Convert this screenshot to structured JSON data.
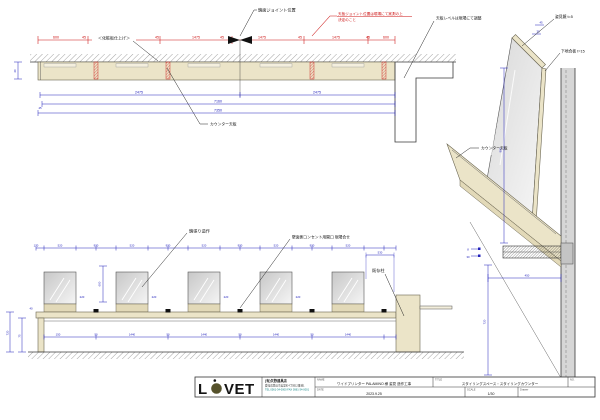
{
  "colors": {
    "beige": "#ebe4c8",
    "beige_dark": "#e2d9b8",
    "blue": "#2222bb",
    "red": "#cc1111",
    "teal": "#0a8080",
    "logo_olive": "#55512b",
    "wall_gray": "#d6d6d6"
  },
  "plan": {
    "labels": {
      "joint": "鏡面ジョイント位置",
      "note1": "天板ジョイント位置は現場にて実測の上",
      "note2": "決定のこと",
      "level": "天板レベルは現場にて調整",
      "finish": "＜化粧板仕上げ＞",
      "counter": "カウンター天板"
    },
    "red_dims": [
      "600",
      "45",
      "1475",
      "45",
      "1475",
      "45",
      "1475",
      "45",
      "1475",
      "45",
      "600"
    ],
    "blue_dims": {
      "half_a": "2475",
      "half_b": "2475",
      "inner": "7160",
      "overall": "7350",
      "depth": "40",
      "offset": "45"
    }
  },
  "elevation": {
    "top_dims": [
      "170",
      "520",
      "930",
      "520",
      "930",
      "520",
      "930",
      "520",
      "930",
      "520"
    ],
    "bottom_dims": [
      "150",
      "50",
      "1440",
      "50",
      "1440",
      "50",
      "1440",
      "50",
      "1440"
    ],
    "gap_dim": "530",
    "side_dim": "220",
    "mirror_h": "600",
    "left_dims": {
      "top": "40",
      "apron": "75",
      "height": "720"
    },
    "labels": {
      "mirror": "鏡張り造作",
      "outlet": "壁面側コンセント用開口 現場合せ",
      "column": "既存柱"
    }
  },
  "section": {
    "labels": {
      "mirror": "姿見鏡 t=5",
      "backing": "下地合板 t=15",
      "counter": "カウンター天板"
    },
    "dims": {
      "height": "900",
      "leg": "720",
      "depth": "450",
      "top_a": "45",
      "top_b": "30",
      "fix_a": "8",
      "fix_b": "30"
    }
  },
  "titleblock": {
    "logo_l": "L",
    "logo_vet": "VET",
    "company_name": "(有)矢野建具店",
    "company_address": "愛知県豊田市美里町4丁目12番地1",
    "company_tel": "TEL 0561-34-0000  FAX 0561-34-0001",
    "name_label": "NAME",
    "name_value": "ワイドプリンター PALAMINO 様 姿見 造作工事",
    "title_label": "TITLE",
    "title_value": "スタイリングスペース・スタイリングカウンター",
    "no_label": "NO.",
    "date_label": "DATE",
    "date_value": "2023.9.25",
    "scale_label": "SCALE",
    "scale_value": "1/30",
    "drawer_label": "Drawer",
    "drawer_value": ""
  }
}
